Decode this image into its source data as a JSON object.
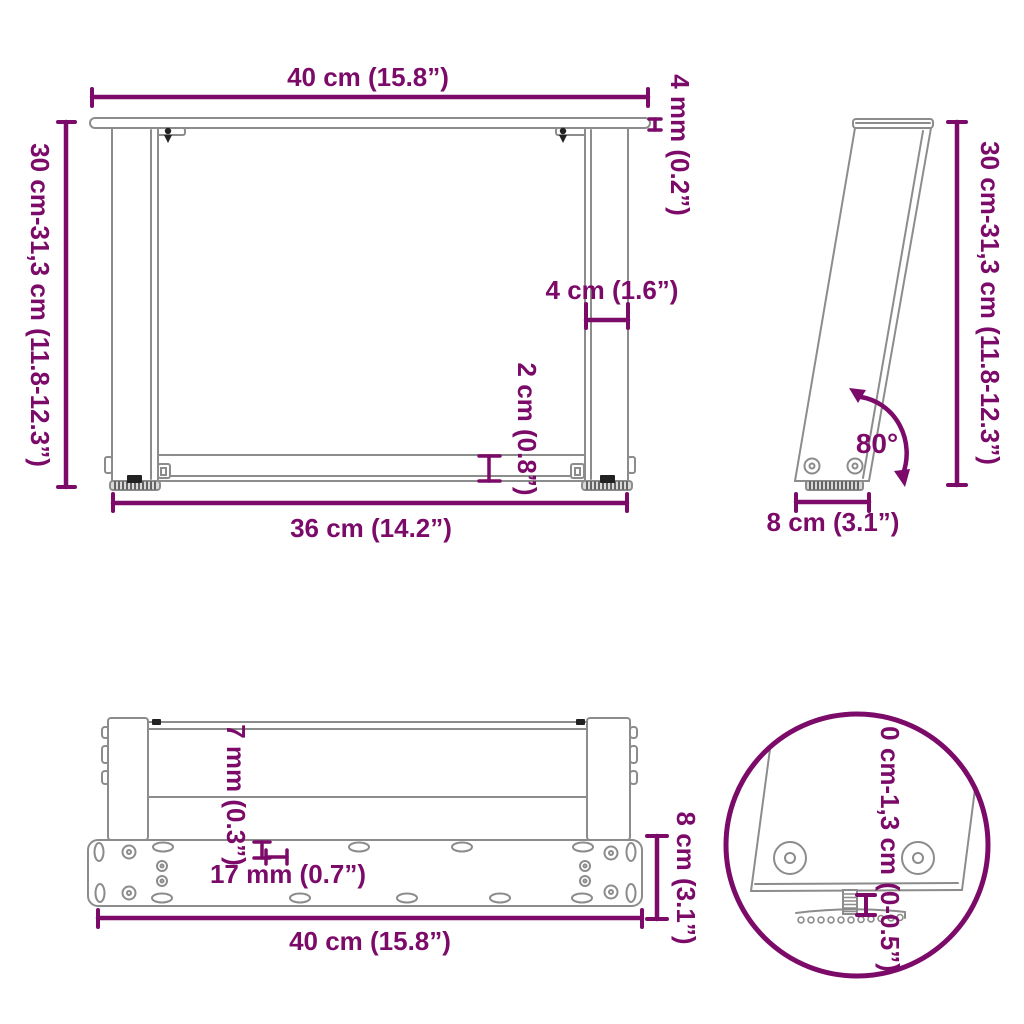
{
  "title": "Table legs U-shape dimension diagram",
  "colors": {
    "accent": "#7B0A69",
    "line": "#8C8C8C",
    "dark": "#222222",
    "pad_fill": "#d9d9d9"
  },
  "views": {
    "front": {
      "labels": {
        "top_width": "40 cm (15.8”)",
        "height": "30 cm-31,3 cm (11.8-12.3”)",
        "top_thickness": "4 mm (0.2”)",
        "leg_width": "4 cm (1.6”)",
        "bar_height": "2 cm (0.8”)",
        "bottom_width": "36 cm (14.2”)"
      }
    },
    "side": {
      "labels": {
        "height": "30 cm-31,3 cm (11.8-12.3”)",
        "angle": "80°",
        "foot_width": "8 cm (3.1”)"
      }
    },
    "plan": {
      "labels": {
        "edge_thickness": "7 mm (0.3”)",
        "slot_length": "17 mm (0.7”)",
        "width": "40 cm (15.8”)",
        "plate_depth": "8 cm (3.1”)"
      }
    },
    "detail": {
      "labels": {
        "adjust_range": "0 cm-1,3 cm (0-0.5”)"
      }
    }
  }
}
